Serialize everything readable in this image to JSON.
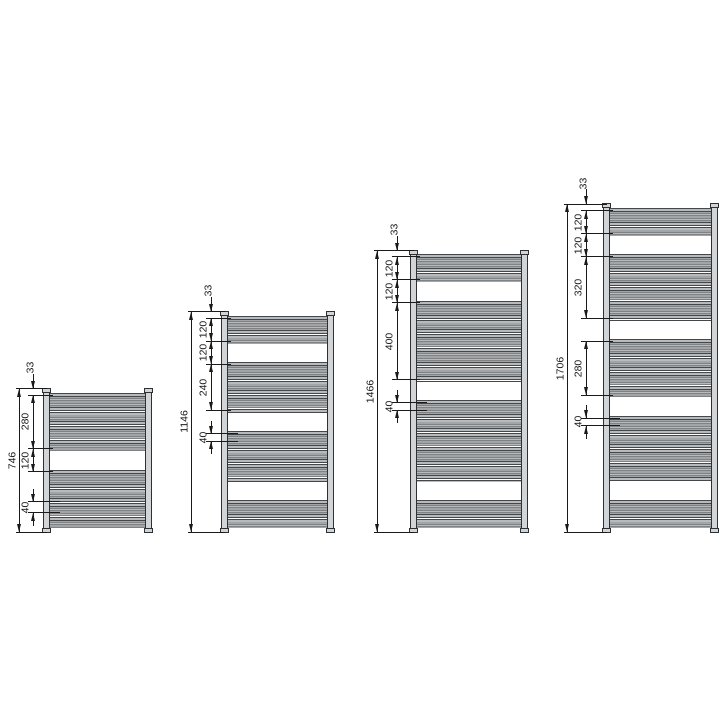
{
  "diagram": {
    "description": "Dimension drawing of four ladder towel radiators, bottom-aligned, with height callouts in mm",
    "units": "mm",
    "scale_px_per_mm": 0.192,
    "baseline_y": 532,
    "colors": {
      "line": "#1a1a1a",
      "collector_fill": "#d2d5d7",
      "collector_edge": "#2d3133",
      "rail_fill": "#b7bbbe",
      "rail_edge": "#44484b",
      "background": "#ffffff"
    },
    "radiators": [
      {
        "id": "radiator-746",
        "overall_label": "746",
        "height_mm": 746,
        "top_offset_label": "33",
        "top_offset_mm": 33,
        "forty_label": "40",
        "body_left": 43,
        "body_width": 109,
        "overall_dim_offset": -24,
        "section_dim_offset": -10,
        "rail_groups_mm": [
          [
            33,
            313
          ],
          [
            433,
            713
          ]
        ],
        "dim_runs": [
          {
            "boundaries_mm": [
              33,
              313,
              433
            ],
            "labels": [
              "280",
              "120"
            ]
          }
        ],
        "forty_ticks_mm": [
          588,
          645
        ]
      },
      {
        "id": "radiator-1146",
        "overall_label": "1146",
        "height_mm": 1146,
        "top_offset_label": "33",
        "top_offset_mm": 33,
        "forty_label": "40",
        "body_left": 221,
        "body_width": 113,
        "overall_dim_offset": -30,
        "section_dim_offset": -10,
        "rail_groups_mm": [
          [
            33,
            153
          ],
          [
            273,
            513
          ],
          [
            633,
            873
          ],
          [
            993,
            1113
          ]
        ],
        "dim_runs": [
          {
            "boundaries_mm": [
              33,
              153,
              273,
              513
            ],
            "labels": [
              "120",
              "120",
              "240"
            ]
          }
        ],
        "forty_ticks_mm": [
          633,
          673
        ]
      },
      {
        "id": "radiator-1466",
        "overall_label": "1466",
        "height_mm": 1466,
        "top_offset_label": "33",
        "top_offset_mm": 33,
        "forty_label": "40",
        "body_left": 410,
        "body_width": 118,
        "overall_dim_offset": -33,
        "section_dim_offset": -13,
        "rail_groups_mm": [
          [
            33,
            153
          ],
          [
            273,
            673
          ],
          [
            793,
            1193
          ],
          [
            1313,
            1433
          ]
        ],
        "dim_runs": [
          {
            "boundaries_mm": [
              33,
              153,
              273,
              673
            ],
            "labels": [
              "120",
              "120",
              "400"
            ]
          }
        ],
        "forty_ticks_mm": [
          793,
          833
        ]
      },
      {
        "id": "radiator-1706",
        "overall_label": "1706",
        "height_mm": 1706,
        "top_offset_label": "33",
        "top_offset_mm": 33,
        "forty_label": "40",
        "body_left": 603,
        "body_width": 115,
        "overall_dim_offset": -36,
        "section_dim_offset": -17,
        "rail_groups_mm": [
          [
            33,
            153
          ],
          [
            273,
            593
          ],
          [
            713,
            993
          ],
          [
            1113,
            1433
          ],
          [
            1553,
            1673
          ]
        ],
        "dim_runs": [
          {
            "boundaries_mm": [
              33,
              153,
              273,
              593
            ],
            "labels": [
              "120",
              "120",
              "320"
            ]
          },
          {
            "boundaries_mm": [
              713,
              993
            ],
            "labels": [
              "280"
            ]
          }
        ],
        "forty_ticks_mm": [
          1113,
          1153
        ]
      }
    ]
  }
}
